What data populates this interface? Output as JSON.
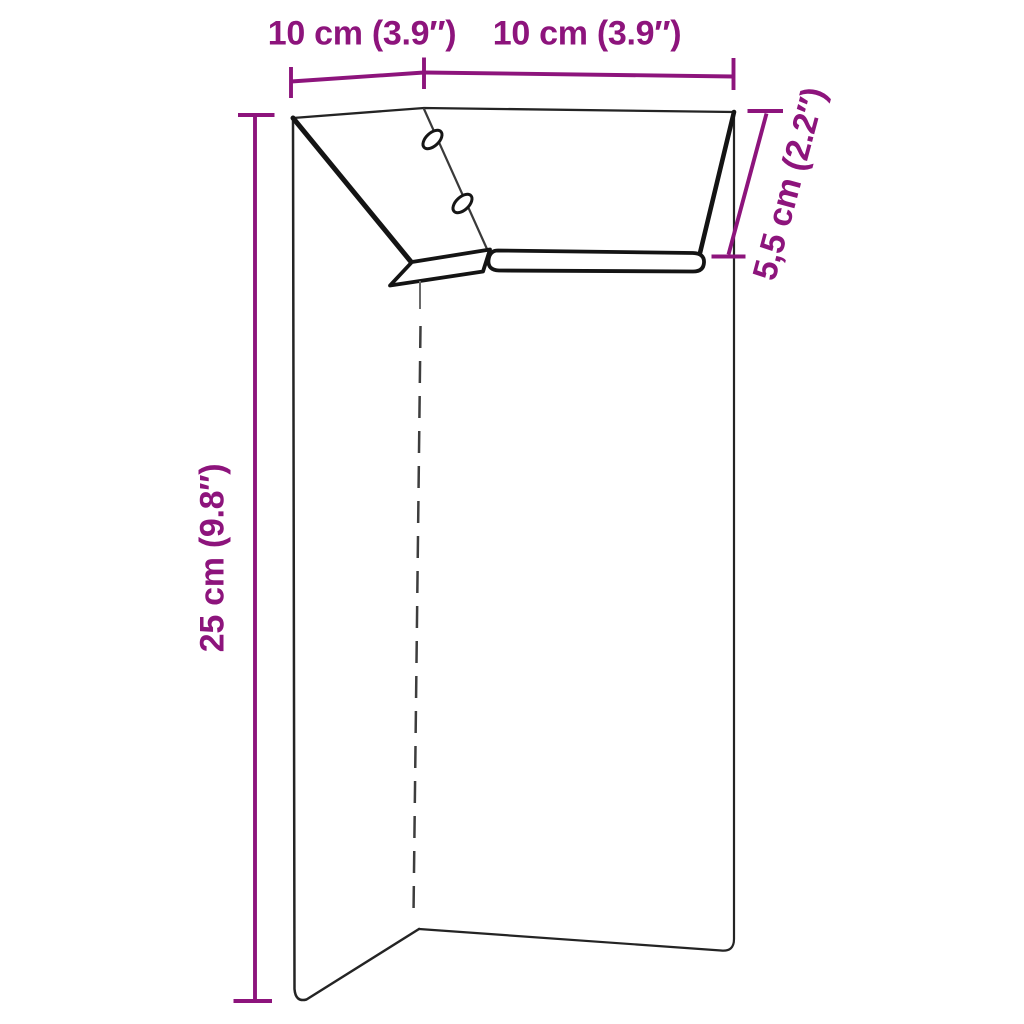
{
  "diagram": {
    "kind": "product-dimension-line-drawing",
    "background": "#ffffff",
    "accent_color": "#8d147c",
    "line_color": "#1a1a1a",
    "dimensions": {
      "top_left": {
        "label": "10 cm (3.9″)",
        "value_cm": "10",
        "value_in": "3.9"
      },
      "top_right": {
        "label": "10 cm (3.9″)",
        "value_cm": "10",
        "value_in": "3.9"
      },
      "right": {
        "label": "5,5 cm (2.2″)",
        "value_cm": "5,5",
        "value_in": "2.2"
      },
      "left": {
        "label": "25 cm (9.8″)",
        "value_cm": "25",
        "value_in": "9.8"
      }
    }
  }
}
